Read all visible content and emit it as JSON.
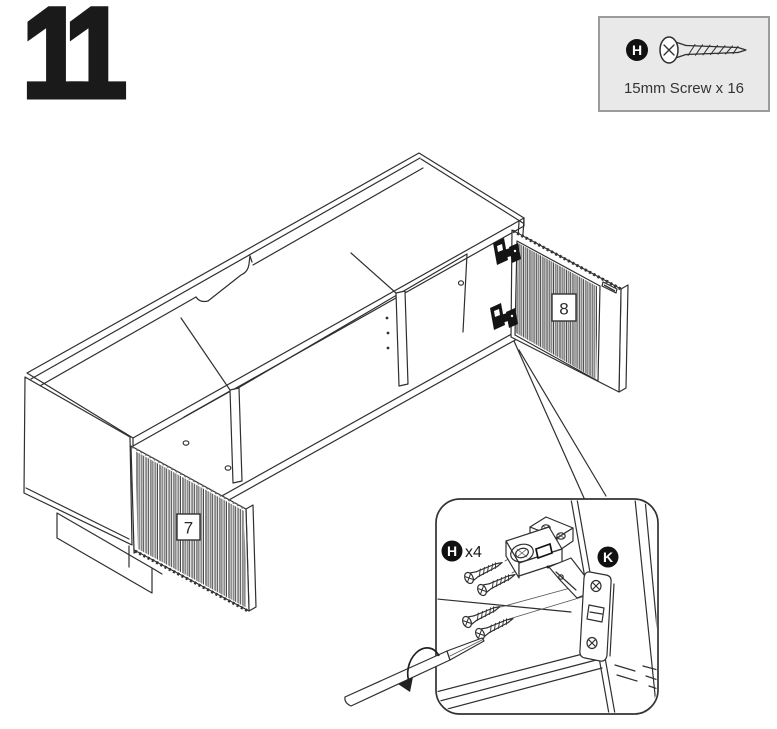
{
  "step_number": "11",
  "hardware_box": {
    "part_letter": "H",
    "label": "15mm Screw x 16"
  },
  "diagram": {
    "left_door_label": "7",
    "right_door_label": "8"
  },
  "callout": {
    "screw_letter": "H",
    "screw_count_label": "x4",
    "hinge_part_letter": "K"
  },
  "colors": {
    "line": "#2f2f2f",
    "badge_fill": "#111111",
    "hardware_box_bg": "#e9e9e9",
    "hardware_box_border": "#9b9b9b"
  }
}
